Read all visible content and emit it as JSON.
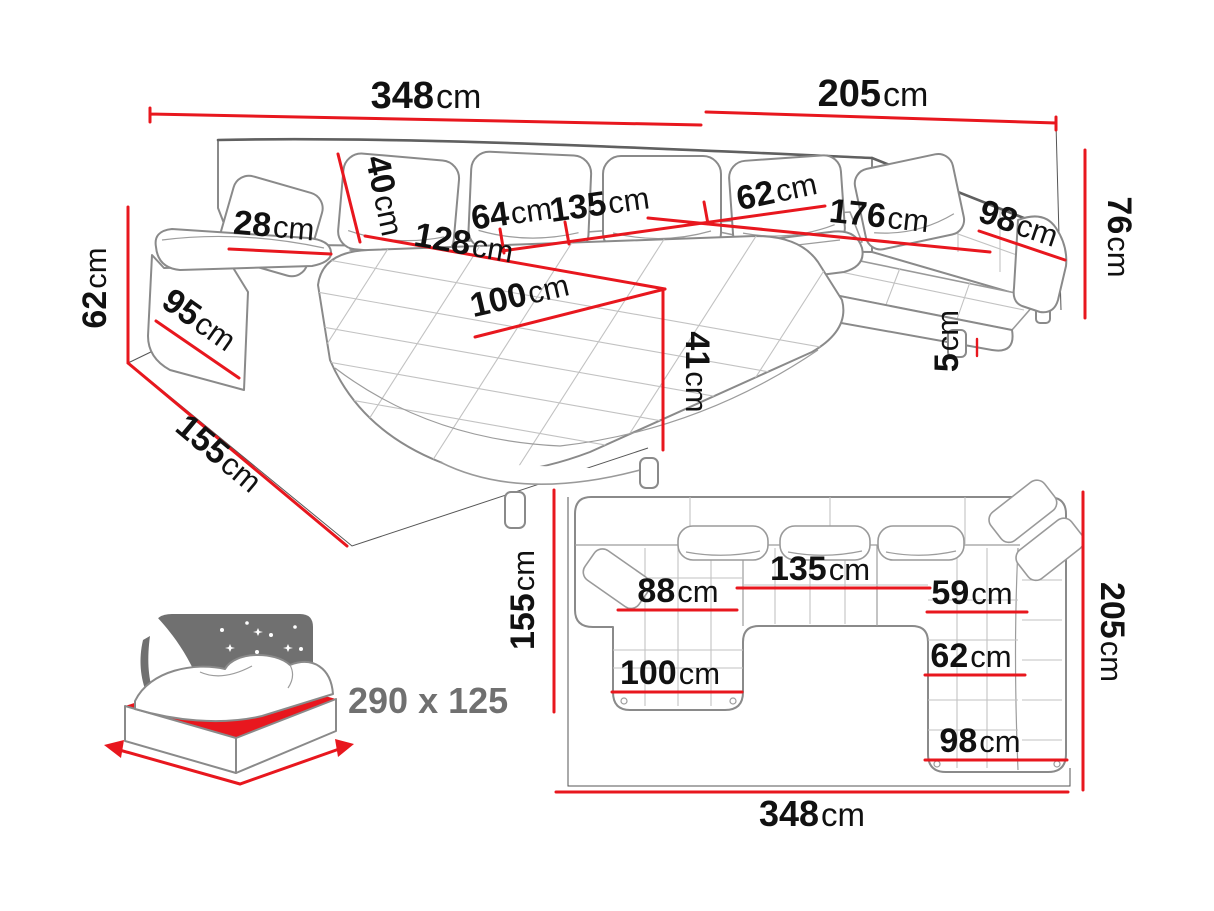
{
  "colors": {
    "dimension_red": "#e8171e",
    "label_black": "#111111",
    "sofa_outline_gray": "#8a8a8a",
    "icon_gray": "#707070"
  },
  "perspective": {
    "labels": [
      {
        "id": "total-width",
        "num": "348",
        "unit": "cm"
      },
      {
        "id": "right-width",
        "num": "205",
        "unit": "cm"
      },
      {
        "id": "back-height",
        "num": "76",
        "unit": "cm"
      },
      {
        "id": "side-seat-height",
        "num": "62",
        "unit": "cm"
      },
      {
        "id": "chaise-depth",
        "num": "155",
        "unit": "cm"
      },
      {
        "id": "arm-side",
        "num": "95",
        "unit": "cm"
      },
      {
        "id": "armrest-width",
        "num": "28",
        "unit": "cm"
      },
      {
        "id": "cushion-height",
        "num": "40",
        "unit": "cm"
      },
      {
        "id": "seat-64",
        "num": "64",
        "unit": "cm"
      },
      {
        "id": "seat-135",
        "num": "135",
        "unit": "cm"
      },
      {
        "id": "seat-62",
        "num": "62",
        "unit": "cm"
      },
      {
        "id": "chaise-length",
        "num": "128",
        "unit": "cm"
      },
      {
        "id": "chaise-width",
        "num": "100",
        "unit": "cm"
      },
      {
        "id": "chaise-height",
        "num": "41",
        "unit": "cm"
      },
      {
        "id": "seat-176",
        "num": "176",
        "unit": "cm"
      },
      {
        "id": "seat-98",
        "num": "98",
        "unit": "cm"
      },
      {
        "id": "leg-height",
        "num": "5",
        "unit": "cm"
      }
    ]
  },
  "plan": {
    "labels": [
      {
        "id": "chaise-depth",
        "num": "155",
        "unit": "cm"
      },
      {
        "id": "seat-88",
        "num": "88",
        "unit": "cm"
      },
      {
        "id": "seat-135",
        "num": "135",
        "unit": "cm"
      },
      {
        "id": "seat-59",
        "num": "59",
        "unit": "cm"
      },
      {
        "id": "right-depth",
        "num": "205",
        "unit": "cm"
      },
      {
        "id": "seat-62",
        "num": "62",
        "unit": "cm"
      },
      {
        "id": "chaise-100",
        "num": "100",
        "unit": "cm"
      },
      {
        "id": "seat-98",
        "num": "98",
        "unit": "cm"
      },
      {
        "id": "total-width",
        "num": "348",
        "unit": "cm"
      }
    ]
  },
  "sleeping": {
    "size": "290 x 125"
  }
}
